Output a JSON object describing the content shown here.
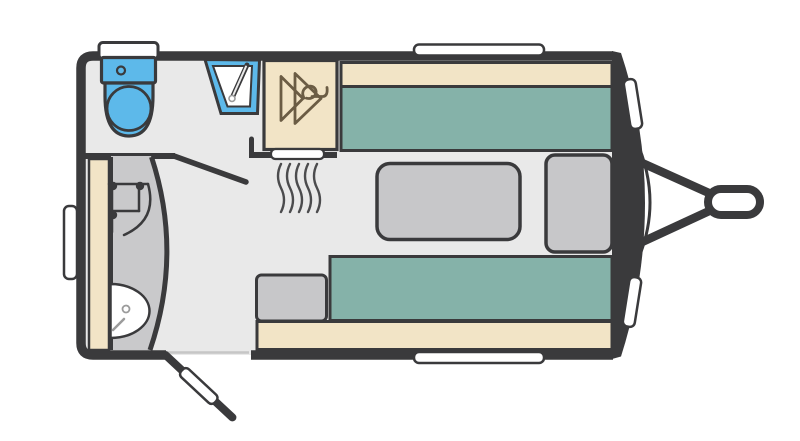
{
  "diagram": {
    "kind": "caravan-floorplan",
    "colors": {
      "background": "#ffffff",
      "outline": "#3a3a3c",
      "floor": "#e9e9e9",
      "wetroom": "#c9c9cb",
      "furniture": "#c7c7c9",
      "cushion": "#85b2a9",
      "trim": "#f2e4c6",
      "plumbing": "#5db9ea",
      "white": "#ffffff",
      "hanger": "#6b5c44",
      "heat": "#4b4b4d",
      "detail": "#9b9b9b",
      "threshold": "#c6c6c6"
    },
    "components": [
      "caravan-shell",
      "floor",
      "front-wall",
      "front-skin-line",
      "tow-hitch",
      "hitch-bar-upper",
      "hitch-bar-lower",
      "tow-ball-coupling",
      "window-top",
      "window-bottom",
      "window-left",
      "window-front-upper",
      "window-front-lower",
      "bathroom",
      "bathroom-partition-wall",
      "bathroom-door-wall",
      "toilet",
      "toilet-lid",
      "toilet-cistern",
      "toilet-flush-button",
      "toilet-bowl",
      "toilet-seat",
      "washbasin",
      "basin-bowl",
      "basin-tap",
      "basin-tap-knob",
      "vanity-unit",
      "shower-cubicle",
      "shower-wall-curve",
      "shower-mixer",
      "shower-tray",
      "shower-drain",
      "shower-handle",
      "wardrobe",
      "hanger-icon",
      "heater-vent",
      "heat-waves-icon",
      "lounge",
      "front-bench-backrest",
      "front-bench-cushion",
      "rear-bench-cushion",
      "rear-bench-backrest",
      "storage-box",
      "dinette-table",
      "front-chest",
      "entrance-door",
      "door-leaf",
      "door-threshold"
    ]
  }
}
